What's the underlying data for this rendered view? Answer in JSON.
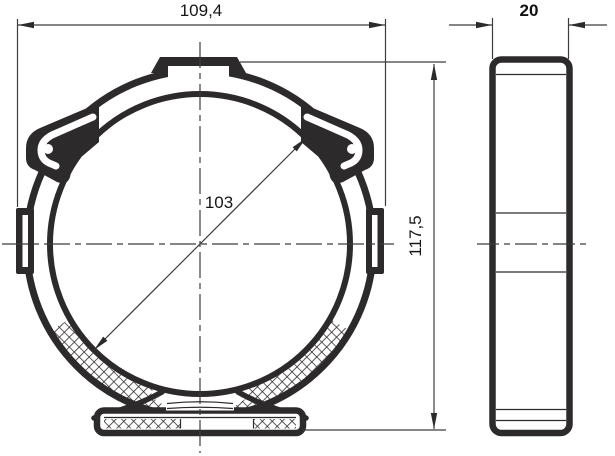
{
  "drawing": {
    "dimensions": {
      "outer_width": "109,4",
      "depth": "20",
      "inner_diameter": "103",
      "overall_height": "117,5"
    },
    "colors": {
      "part_line": "#2d2a2b",
      "thin_line": "#3c3c3e",
      "text": "#161616",
      "background": "#ffffff"
    }
  }
}
